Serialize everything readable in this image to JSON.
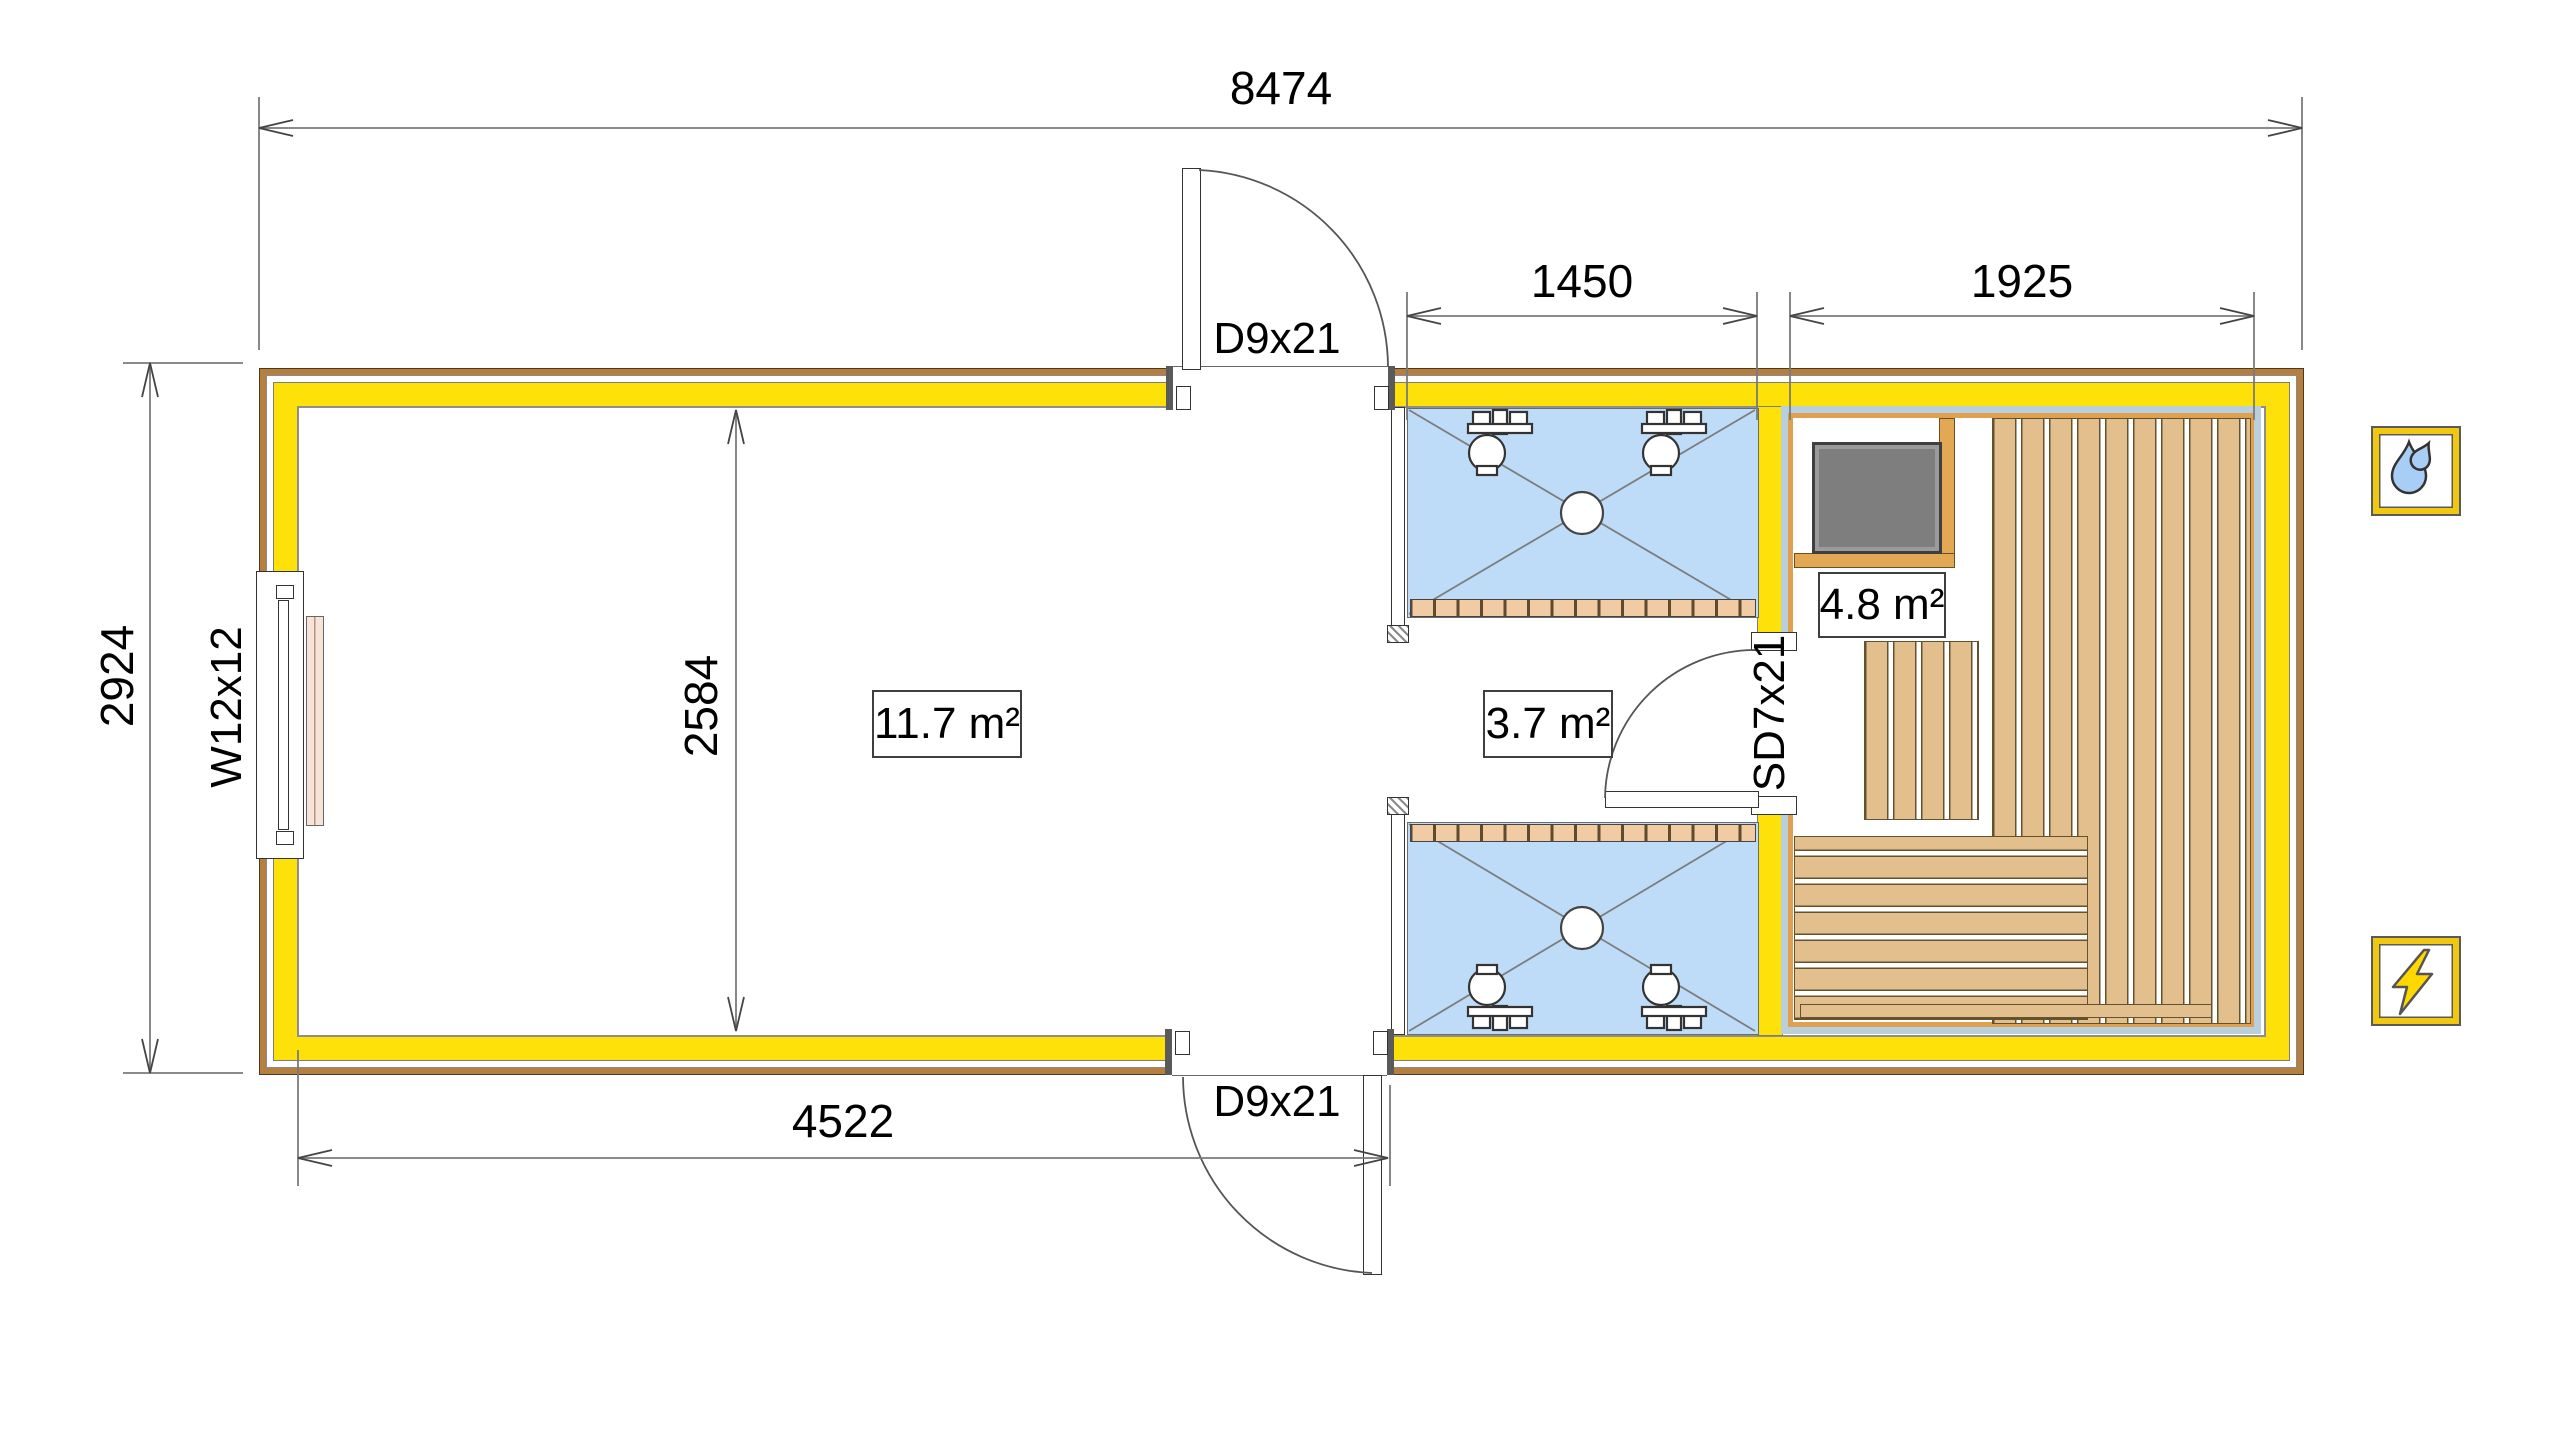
{
  "plan": {
    "dims": {
      "overall_width": "8474",
      "overall_depth": "2924",
      "interior_depth": "2584",
      "main_room_width": "4522",
      "shower_room_width": "1450",
      "sauna_width": "1925"
    },
    "rooms": [
      {
        "name": "main-room",
        "area": "11.7 m²"
      },
      {
        "name": "shower-room",
        "area": "3.7 m²"
      },
      {
        "name": "sauna",
        "area": "4.8 m²"
      }
    ],
    "openings": {
      "door_top": "D9x21",
      "door_bottom": "D9x21",
      "sauna_door": "SD7x21",
      "window": "W12x12"
    },
    "legend": [
      {
        "name": "water-icon",
        "meaning": "water connection"
      },
      {
        "name": "electric-icon",
        "meaning": "electrical connection"
      }
    ],
    "colors": {
      "wall_insulation_yellow": "#FFE10A",
      "cladding_brown": "#B5803F",
      "sauna_liner_blue": "#B9CFDB",
      "sauna_panel_orange": "#DFA050",
      "bench_wood": "#E3BF8D",
      "shower_floor_blue": "#BEDCF7",
      "stove_gray": "#7E7E7E",
      "icon_frame_yellow": "#F0C810",
      "water_drop_blue": "#A8CEF5",
      "bolt_yellow": "#FFD800"
    }
  }
}
